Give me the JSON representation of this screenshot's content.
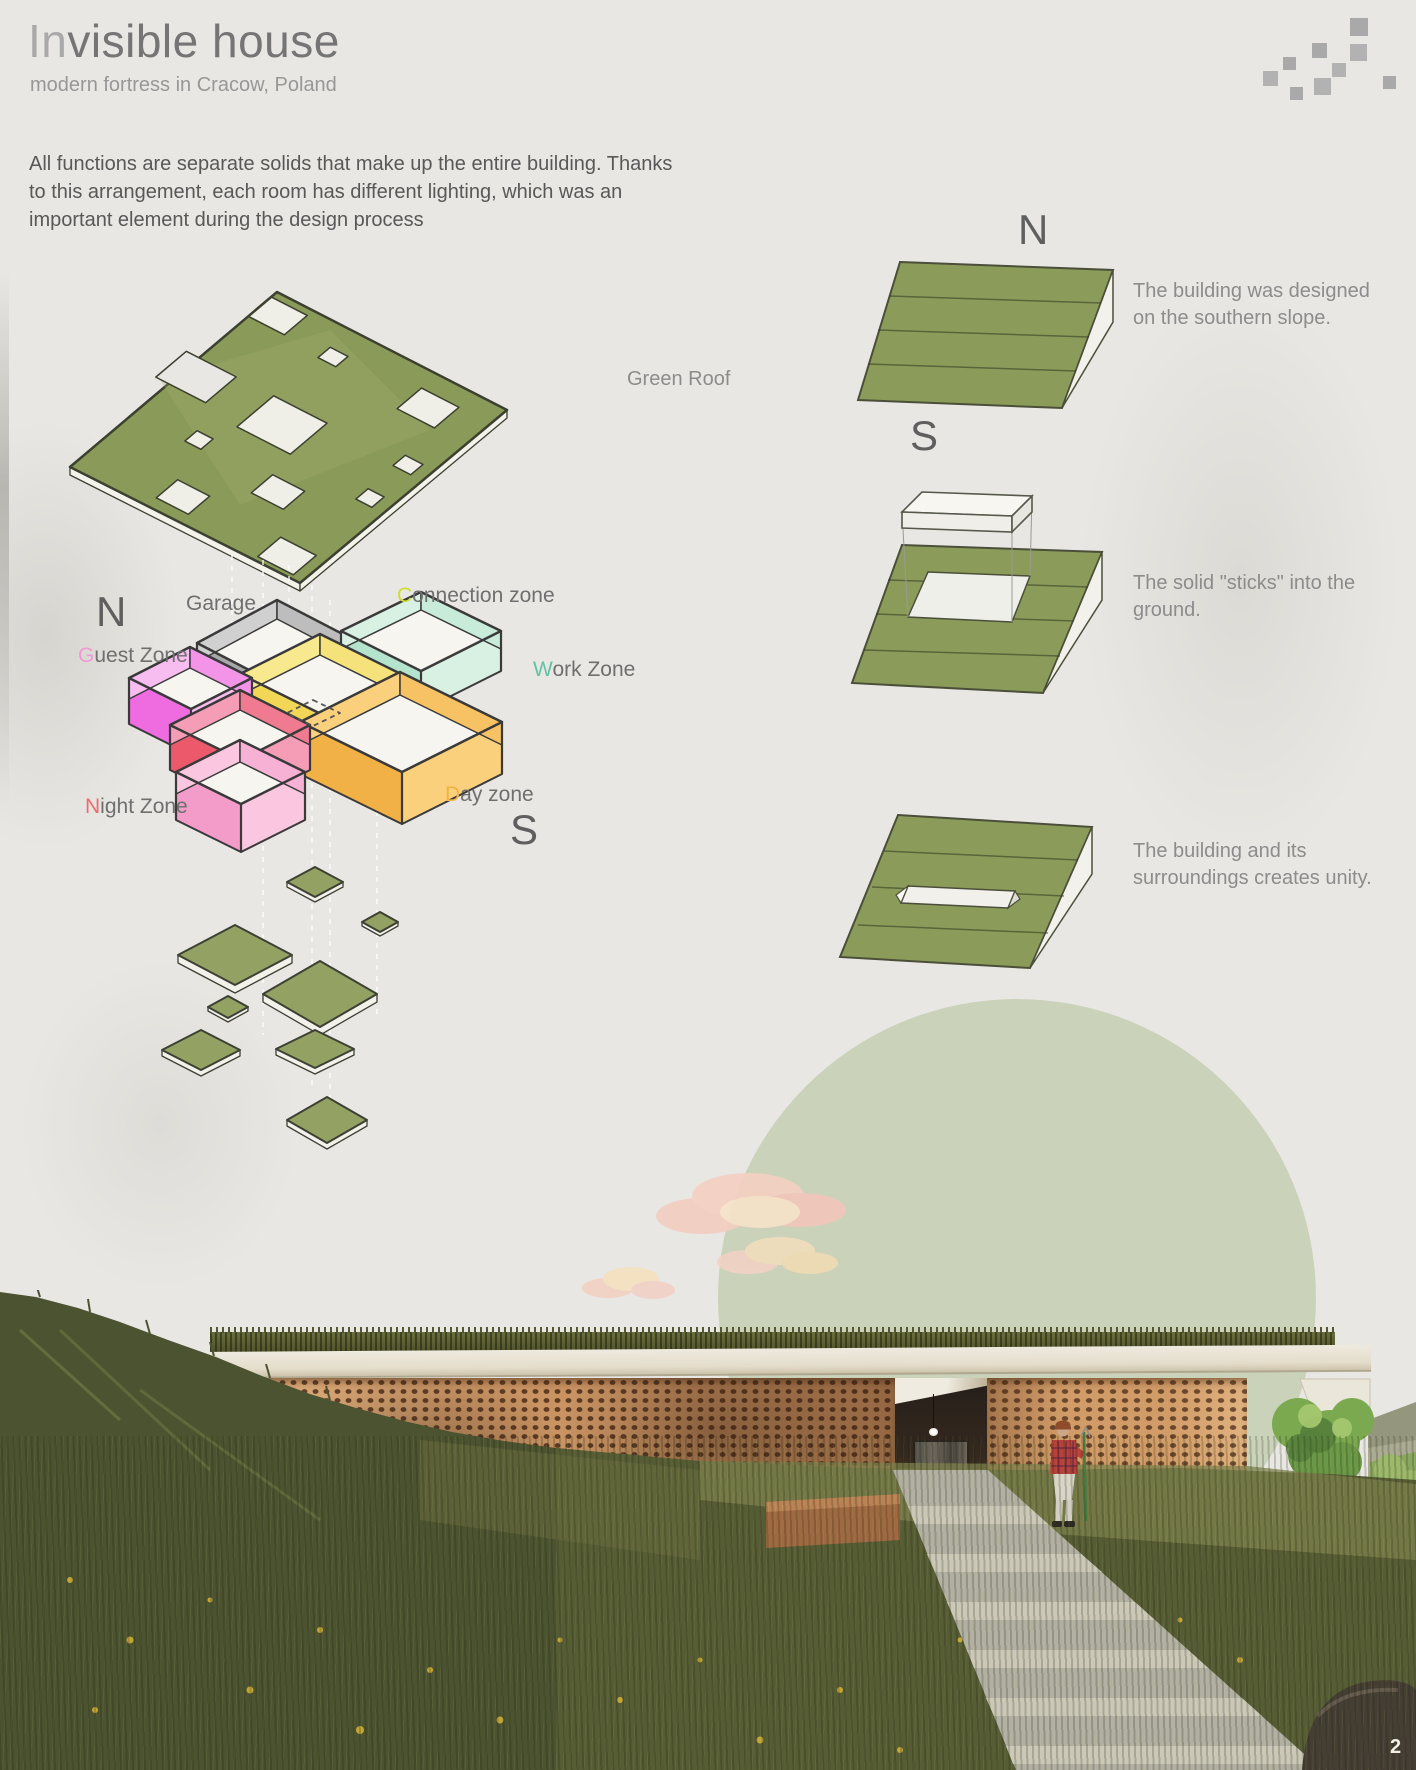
{
  "page": {
    "page_number": "2",
    "paper_color": "#e9e7e3"
  },
  "header": {
    "title_prefix": "In",
    "title_rest": "visible house",
    "subtitle": "modern fortress in Cracow, Poland"
  },
  "intro": {
    "lines": [
      "All functions are separate solids that make up the entire building. Thanks",
      "to this arrangement, each room has different lighting, which was an",
      "important element during the design process"
    ]
  },
  "logo": {
    "square_color": "#a9a9a9",
    "square_count": 9
  },
  "exploded": {
    "green_roof_label": "Green Roof",
    "compass_north": "N",
    "compass_south": "S",
    "roof_color": "#8a9a58",
    "plate_color": "#93a262",
    "zones": {
      "garage": {
        "label": "Garage",
        "wall_light": "#d0d0d0",
        "wall_dark": "#a8a8a8",
        "inner": "#bdbdbd"
      },
      "connection": {
        "first": "C",
        "rest": "onnection zone",
        "accent": "#cfdc33",
        "wall_light": "#f9e98e",
        "wall_dark": "#f1d755",
        "inner": "#f5e27a"
      },
      "guest": {
        "first": "G",
        "rest": "uest Zone",
        "accent": "#f09ad4",
        "wall_light": "#f8bdf0",
        "wall_dark": "#ee6ce0",
        "inner": "#f394e8"
      },
      "work": {
        "first": "W",
        "rest": "ork Zone",
        "accent": "#5fc3a4",
        "wall_light": "#d8f1e3",
        "wall_dark": "#b4e4ce",
        "inner": "#c9ebd9"
      },
      "night": {
        "first": "N",
        "rest": "ight Zone",
        "accent": "#ed6b6f",
        "wall_light": "#f59cb7",
        "wall_dark": "#eb596a",
        "inner": "#f07b90"
      },
      "night2": {
        "wall_light": "#fbc6e0",
        "wall_dark": "#f39cca",
        "inner": "#f7b1d5"
      },
      "day": {
        "first": "D",
        "rest": "ay zone",
        "accent": "#f0b440",
        "wall_light": "#fbd07d",
        "wall_dark": "#f2b146",
        "inner": "#f6c263"
      }
    }
  },
  "site_diagrams": {
    "compass_north": "N",
    "compass_south": "S",
    "slope_color": "#8b9c5a",
    "captions": [
      {
        "line1": "The building was designed",
        "line2": "on the southern slope."
      },
      {
        "line1": "The solid \"sticks\" into the",
        "line2": "ground."
      },
      {
        "line1": "The building and its",
        "line2": "surroundings creates unity."
      }
    ]
  },
  "rendering": {
    "sun_circle_color": "#cbd2ba"
  }
}
